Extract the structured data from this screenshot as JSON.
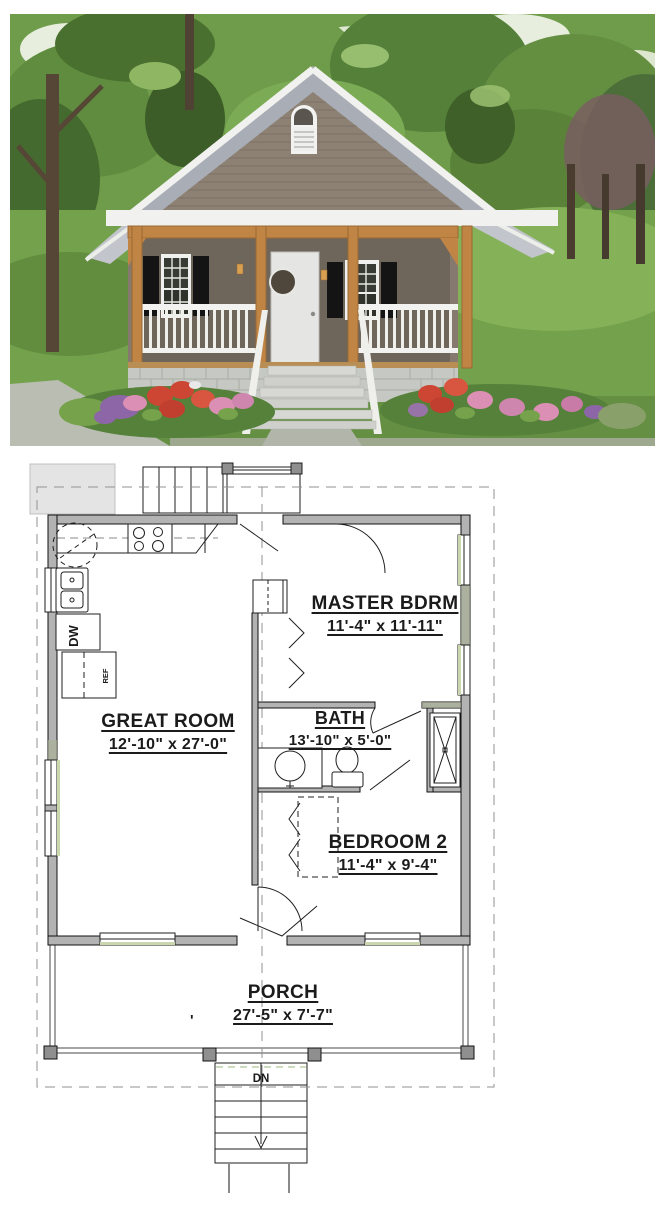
{
  "floor_plan": {
    "rooms": [
      {
        "name": "MASTER BDRM",
        "dims": "11'-4\" x 11'-11\""
      },
      {
        "name": "GREAT ROOM",
        "dims": "12'-10\" x 27'-0\""
      },
      {
        "name": "BATH",
        "dims": "13'-10\" x 5'-0\""
      },
      {
        "name": "BEDROOM 2",
        "dims": "11'-4\" x 9'-4\""
      },
      {
        "name": "PORCH",
        "dims": "27'-5\" x 7'-7\""
      }
    ],
    "labels": {
      "down": "DN",
      "dishwasher": "DW",
      "refrigerator": "REF",
      "tick": "'"
    },
    "colors": {
      "wall": "#b3b3b3",
      "wall_tint": "#a9b195",
      "post": "#8f8f8f",
      "line": "#1f1f1f",
      "dash": "#929292",
      "window_tint": "#c9d6ae",
      "pad": "#e4e4e4"
    }
  },
  "photo": {
    "colors": {
      "canopy": "#6f9c4a",
      "canopy_dark": "#49702e",
      "canopy_light": "#8fb763",
      "sky_patch": "#e8eede",
      "trunk": "#564636",
      "lawn": "#74a14c",
      "roof": "#a9adb6",
      "roof_side": "#c2c5cb",
      "trim": "#f1f2ef",
      "siding": "#8d8173",
      "wall_shadow": "#6e655b",
      "beam": "#c08445",
      "door": "#e5e6e3",
      "shutter": "#141414",
      "foundation": "#c6c8c3",
      "sidewalk": "#b9bdb2",
      "flower_red": "#cc4633",
      "flower_pink": "#dc8fb4",
      "flower_purple": "#8d66a8",
      "bush": "#76a24c"
    }
  }
}
